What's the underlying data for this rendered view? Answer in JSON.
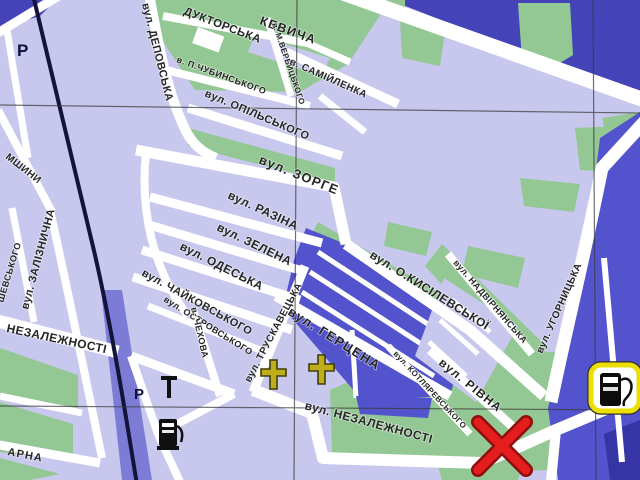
{
  "map": {
    "title": "city street map fragment",
    "streets": [
      {
        "id": "kevycha",
        "name": "КЕВИЧА"
      },
      {
        "id": "konduktorska",
        "name": "ДУКТОРСЬКА"
      },
      {
        "id": "depovska",
        "name": "вул. ДЕПОВСЬКА"
      },
      {
        "id": "chubynskoho",
        "name": "в. П.ЧУБИНСЬКОГО"
      },
      {
        "id": "verbytskoho",
        "name": "в. М.ВЕРБИЦЬКОГО"
      },
      {
        "id": "samiilenka",
        "name": "в. САМІЙЛЕНКА"
      },
      {
        "id": "opilskoho",
        "name": "вул. ОПІЛЬСЬКОГО"
      },
      {
        "id": "zorge",
        "name": "вул. ЗОРГЕ"
      },
      {
        "id": "razina",
        "name": "вул. РАЗІНА"
      },
      {
        "id": "zelena",
        "name": "вул. ЗЕЛЕНА"
      },
      {
        "id": "odeska",
        "name": "вул. ОДЕСЬКА"
      },
      {
        "id": "chaikovskoho",
        "name": "вул. ЧАЙКОВСЬКОГО"
      },
      {
        "id": "ostrovskoho",
        "name": "вул. ОСТРОВСЬКОГО"
      },
      {
        "id": "chekhova",
        "name": "в. ЧЕХОВА"
      },
      {
        "id": "truskavetska",
        "name": "вул. ТРУСКАВЕЦЬКА"
      },
      {
        "id": "hertsena",
        "name": "вул. ГЕРЦЕНА"
      },
      {
        "id": "kysilevskoi",
        "name": "вул. О.КИСІЛЕВСЬКОЇ"
      },
      {
        "id": "nadvirnianska",
        "name": "вул. НАДВІРНЯНСЬКА"
      },
      {
        "id": "uhornytska",
        "name": "вул. УГОРНИЦЬКА"
      },
      {
        "id": "rivna",
        "name": "вул. РІВНА"
      },
      {
        "id": "kotliarevskoho",
        "name": "вул. КОТЛЯРЕВСЬКОГО"
      },
      {
        "id": "nezalezhnosti-center",
        "name": "вул. НЕЗАЛЕЖНОСТІ"
      },
      {
        "id": "nezalezhnosti-left",
        "name": "НЕЗАЛЕЖНОСТІ"
      },
      {
        "id": "zaliznychna",
        "name": "вул. ЗАЛІЗНИЧНА"
      },
      {
        "id": "mshyny-partial",
        "name": "МШИНИ"
      },
      {
        "id": "shevskoho-partial",
        "name": "ШЕВСЬКОГО"
      },
      {
        "id": "arna-partial",
        "name": "АРНА"
      }
    ],
    "symbols": {
      "parking_label": "Р",
      "parking_count": 2,
      "church_cross_count": 2,
      "fuel_station_count": 2,
      "destination_marker": "X"
    },
    "colors": {
      "block_lavender": "#c8c8ee",
      "road_white": "#ffffff",
      "green_area": "#93c793",
      "block_blue": "#5353cd",
      "region_blue": "#4444b8",
      "rail_band": "#7c7cd6",
      "pond_blue": "#3535a6",
      "rail_line": "#14143a",
      "grid_line": "#3a3a3a",
      "label_text": "#262626",
      "marker_red": "#e51d1d",
      "marker_red_dark": "#8f0f0f",
      "cross_gold": "#bfae19",
      "badge_yellow": "#eadf00"
    }
  }
}
